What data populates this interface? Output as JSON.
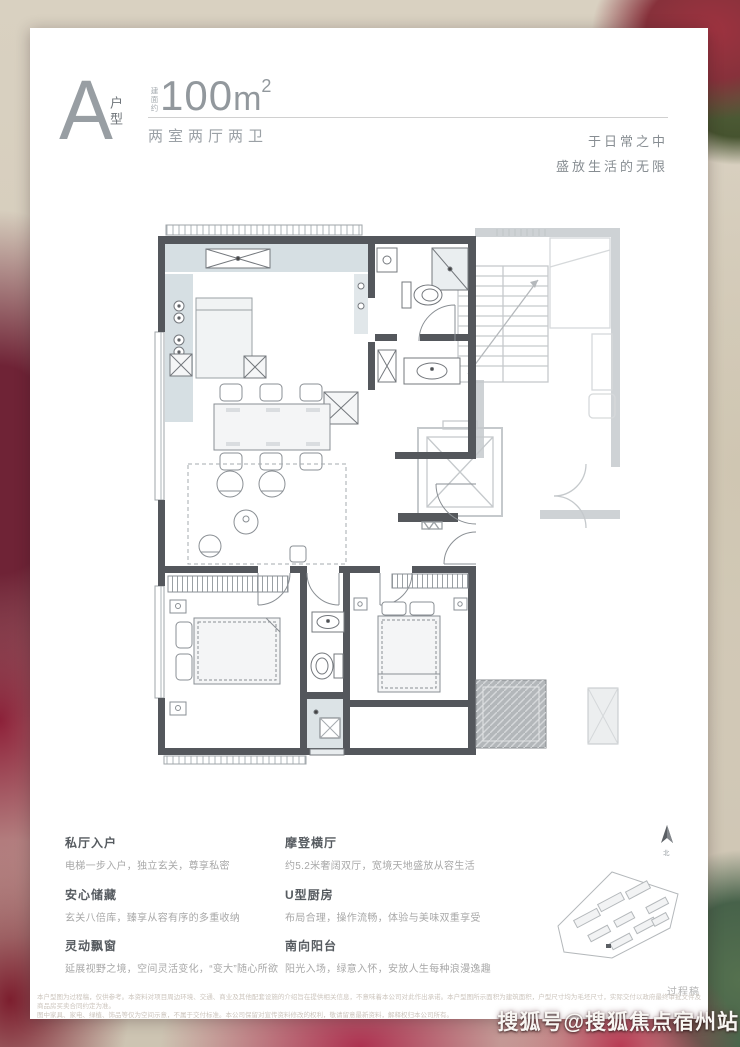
{
  "header": {
    "unit_letter": "A",
    "unit_type_label": "户型",
    "area_prefix": "建面约",
    "area_value": "100",
    "area_unit": "m",
    "area_sup": "2",
    "layout_label": "两室两厅两卫",
    "slogan_line1": "于日常之中",
    "slogan_line2": "盛放生活的无限"
  },
  "features": [
    {
      "title": "私厅入户",
      "desc": "电梯一步入户，独立玄关，尊享私密"
    },
    {
      "title": "安心储藏",
      "desc": "玄关八倍库，臻享从容有序的多重收纳"
    },
    {
      "title": "灵动飘窗",
      "desc": "延展视野之境，空间灵活变化，“变大”随心所欲"
    },
    {
      "title": "摩登横厅",
      "desc": "约5.2米奢阔双厅，宽境天地盛放从容生活"
    },
    {
      "title": "U型厨房",
      "desc": "布局合理，操作流畅，体验与美味双重享受"
    },
    {
      "title": "南向阳台",
      "desc": "阳光入场，绿意入怀，安放人生每种浪漫逸趣"
    }
  ],
  "floorplan": {
    "north_label": "北",
    "draft_label": "过程稿"
  },
  "disclaimer": {
    "line1": "本户型图为过程稿，仅供参考。本资料对项目周边环境、交通、商业及其他配套设施的介绍旨在提供相关信息，不意味着本公司对此作出承诺。本户型图所示面积为建筑面积，户型尺寸均为毛坯尺寸，实际交付以政府最终审批文件及商品房买卖合同约定为准。",
    "line2": "图中家具、家电、绿植、饰品等仅为空间示意，不属于交付标准。本公司保留对宣传资料修改的权利，敬请留意最新资料，解释权归本公司所有。"
  },
  "watermark": {
    "text": "搜狐号@搜狐焦点宿州站"
  }
}
